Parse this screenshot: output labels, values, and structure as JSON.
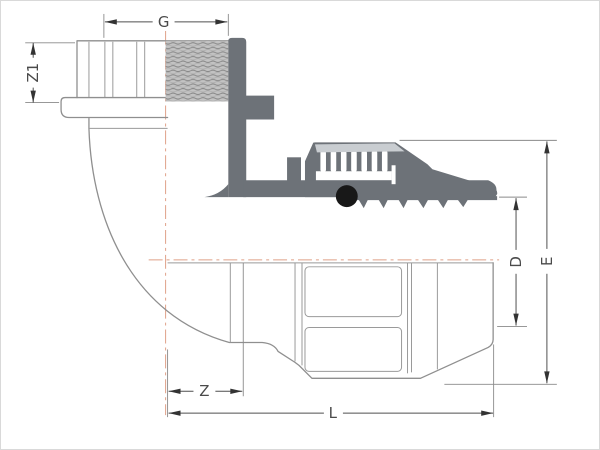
{
  "diagram": {
    "description": "Technical drawing of a 90-degree elbow compression fitting, half-section view with dimension lines",
    "labels": {
      "thread_size": "G",
      "z1": "Z1",
      "diameter_d": "D",
      "height_e": "E",
      "z": "Z",
      "length_l": "L"
    },
    "colors": {
      "body_section": "#6d7278",
      "nut_highlight": "#c9cdd1",
      "o_ring": "#181818",
      "outline": "#8f8f8f",
      "dimension_line": "#4f4f4f",
      "centerline": "#dfa088",
      "thread_fill": "#c3c3c3",
      "background": "#ffffff"
    }
  }
}
